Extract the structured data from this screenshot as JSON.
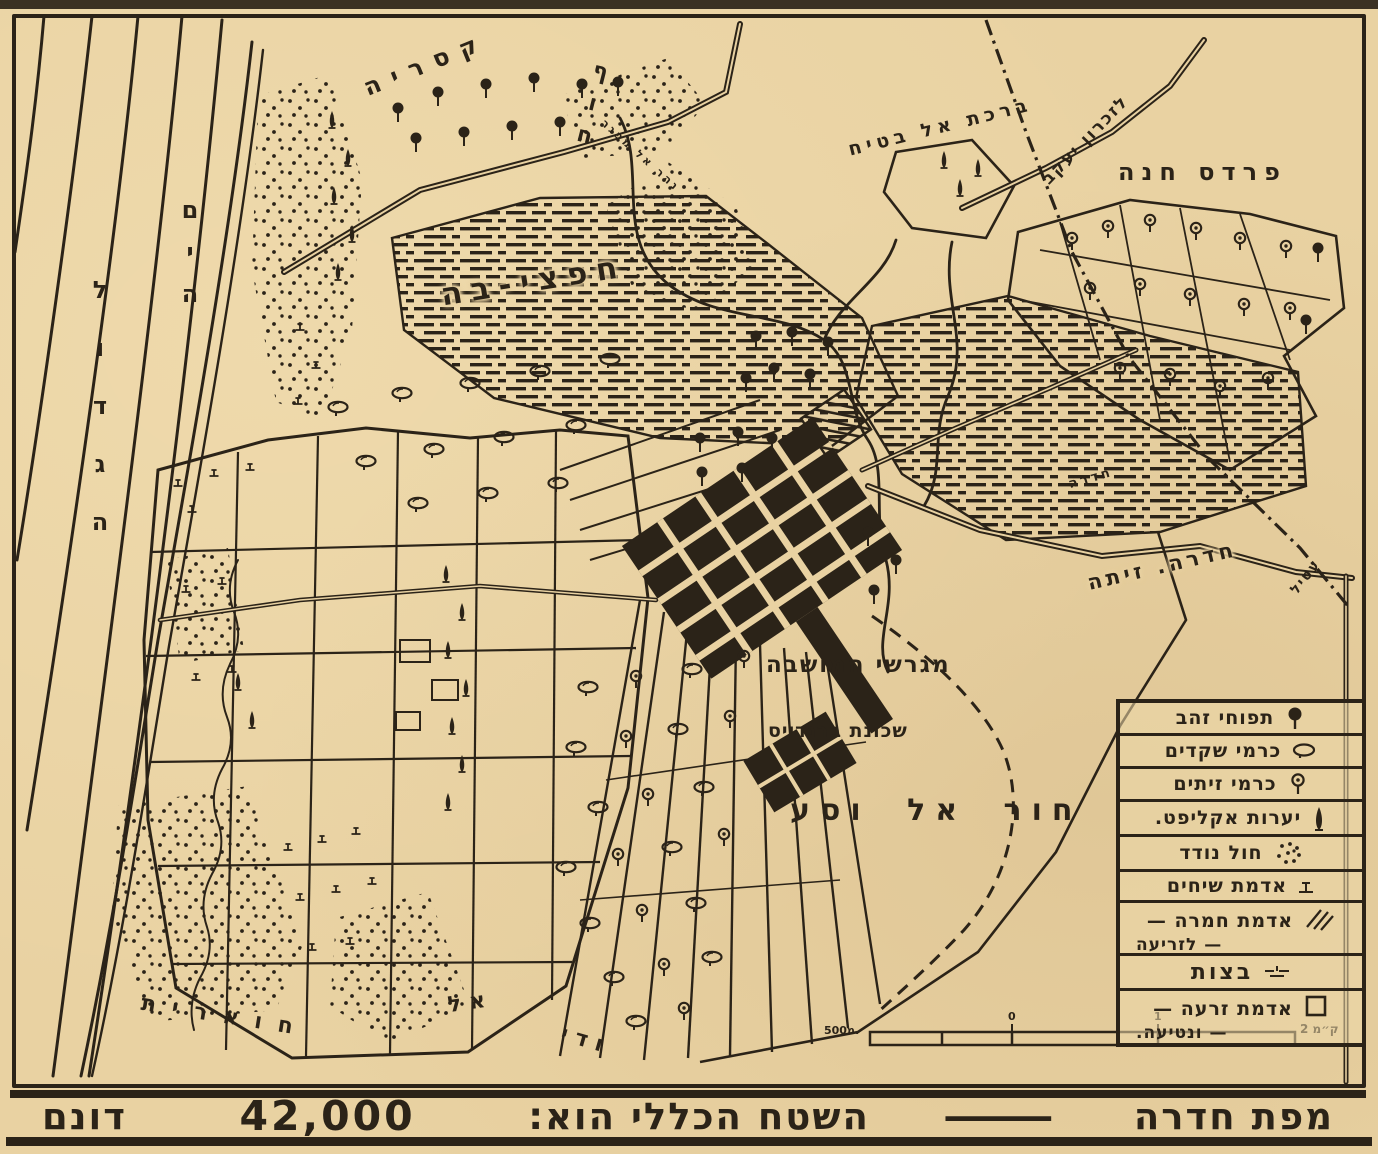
{
  "colors": {
    "paper": "#e9d2a2",
    "ink": "#2b2318"
  },
  "map": {
    "labels": {
      "sea_line1": "הים",
      "sea_line2": "הגדול",
      "coast": "חוף",
      "caesarea": "קסריה",
      "river": "נהר אל מפגר",
      "hefzibah": "חפצי-בה",
      "birkat_al_batih": "ברכת אל בטיח",
      "to_zikhron_yaakov": "לזכרון יעקב",
      "pardes_hanna": "פרדס חנה",
      "hadera_small": "חדרה",
      "hadera_zeita": "חדרה. זיתה",
      "attil": "עטיל",
      "colony_plots": "מגרשי המושבה",
      "brandeis": "שכונת ברנדייס",
      "khor_al_wasa": "חור אל וסע",
      "wadi_word1": "ודי",
      "wadi_word2": "אל",
      "wadi_word3": "חוארית"
    },
    "scale_bar": {
      "left_label": "500מ.",
      "zero_label": "0",
      "one_label": "1",
      "right_label": "2 ק״מ"
    }
  },
  "legend": {
    "items": [
      {
        "label": "תפוחי זהב",
        "symbol": "orange-tree"
      },
      {
        "label": "כרמי שקדים",
        "symbol": "almond-tree"
      },
      {
        "label": "כרמי זיתים",
        "symbol": "olive-tree"
      },
      {
        "label": "יערות אקליפט.",
        "symbol": "eucalyptus-tree"
      },
      {
        "label": "חול נודד",
        "symbol": "drifting-sand"
      },
      {
        "label": "אדמת שיחים",
        "symbol": "shrub-land"
      },
      {
        "label": "אדמת חמרה —",
        "label2": "— לזריעה",
        "symbol": "hamra-soil-hatch"
      },
      {
        "label": "בצות",
        "symbol": "swamp"
      },
      {
        "label": "אדמת זרעה —",
        "label2": "— ונטיעה.",
        "symbol": "sown-land-square"
      }
    ]
  },
  "caption": {
    "title": "מפת חדרה",
    "dash": "—",
    "body": "השטח הכללי הוא:",
    "area_value": "42,000",
    "area_unit": "דונם"
  }
}
